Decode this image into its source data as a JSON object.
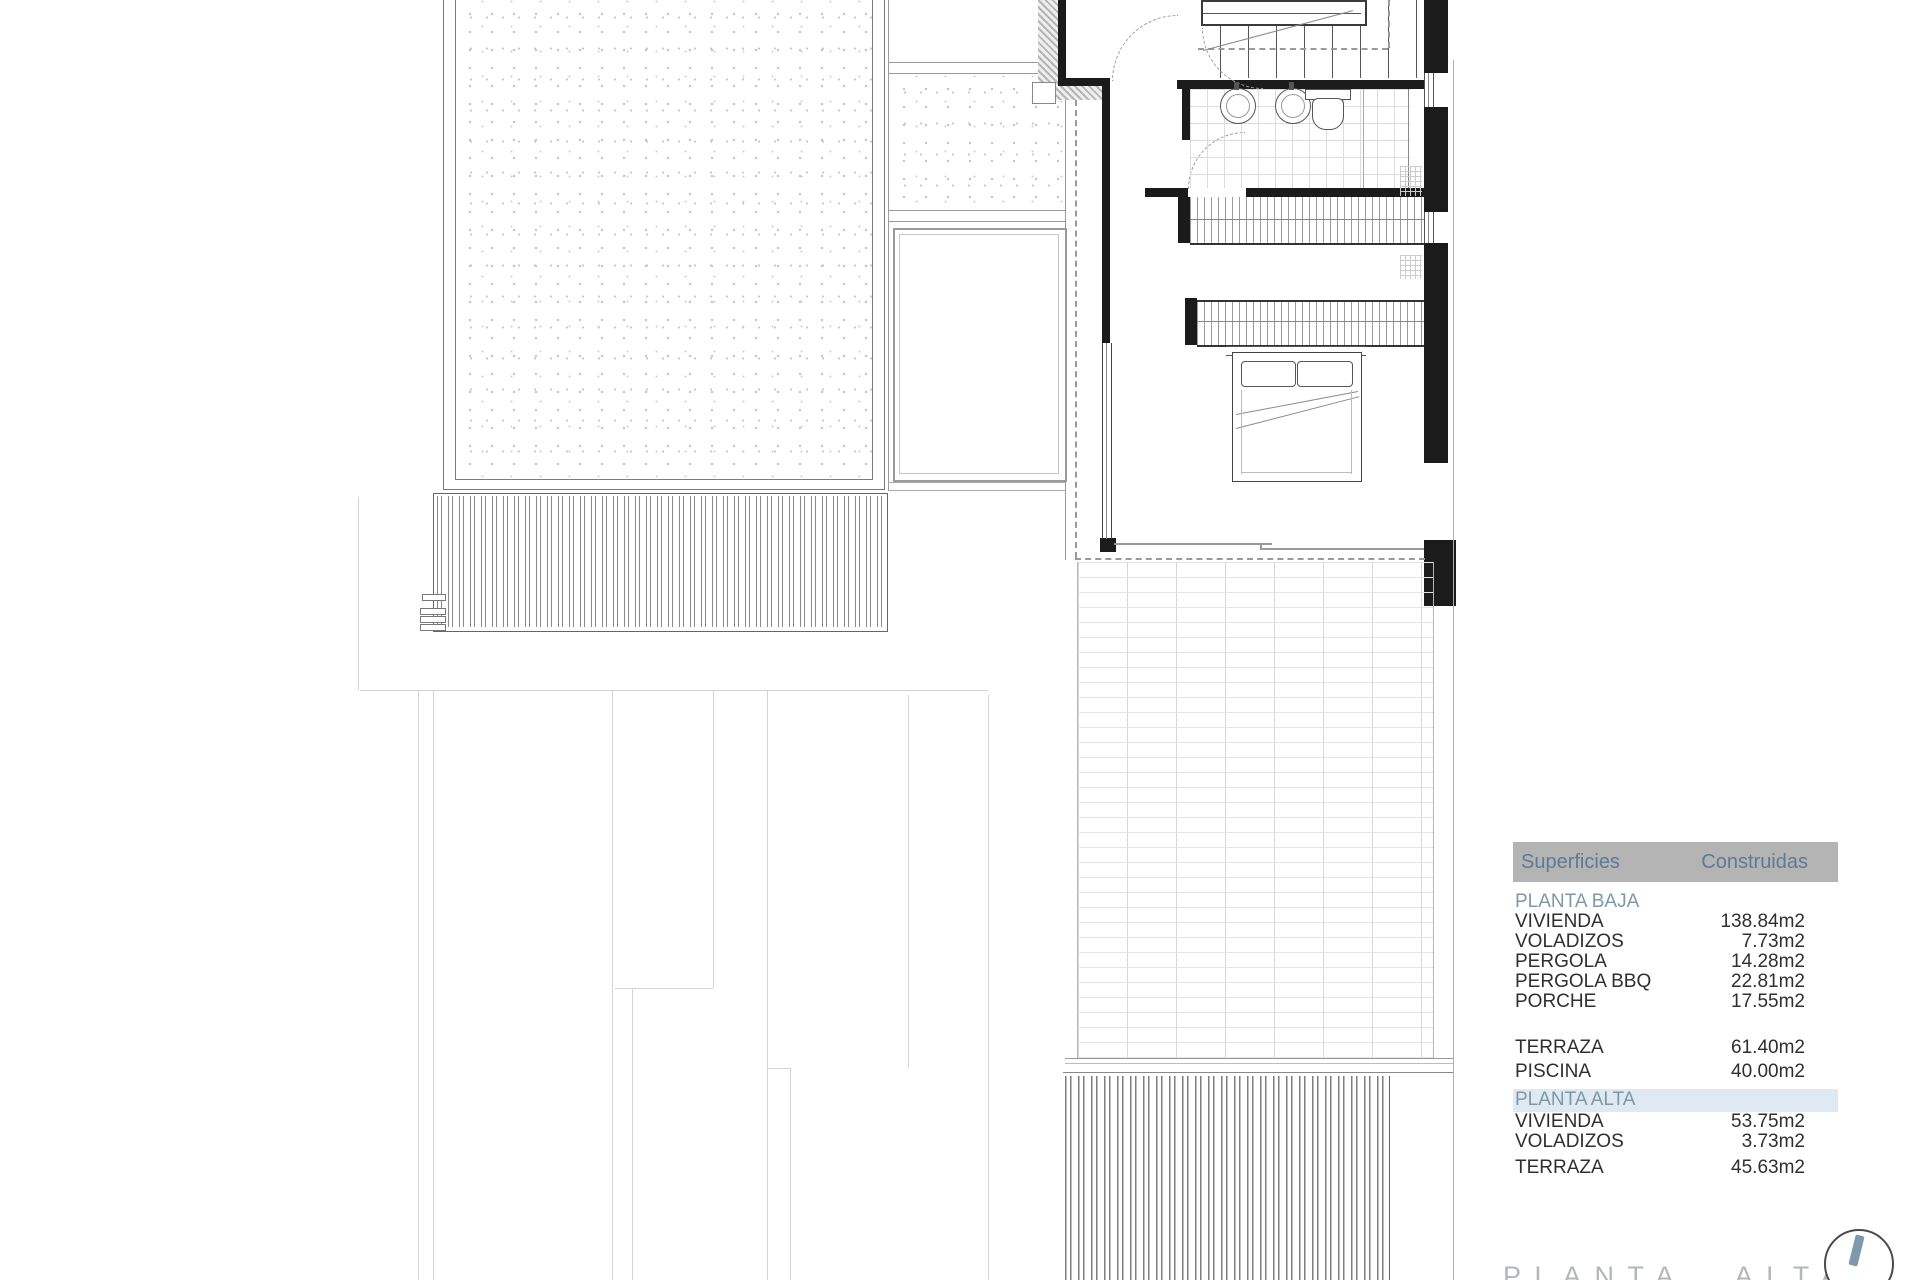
{
  "drawing": {
    "title": "PLANTA ALTA"
  },
  "areas_table": {
    "header": {
      "surfaces": "Superficies",
      "built": "Construidas"
    },
    "rows": [
      {
        "type": "section",
        "label": "PLANTA BAJA",
        "value": ""
      },
      {
        "type": "item",
        "label": "VIVIENDA",
        "value": "138.84m2"
      },
      {
        "type": "item",
        "label": "VOLADIZOS",
        "value": "7.73m2"
      },
      {
        "type": "item",
        "label": "PERGOLA",
        "value": "14.28m2"
      },
      {
        "type": "item",
        "label": "PERGOLA BBQ",
        "value": "22.81m2"
      },
      {
        "type": "item",
        "label": "PORCHE",
        "value": "17.55m2"
      },
      {
        "type": "item",
        "label": "TERRAZA",
        "value": "61.40m2"
      },
      {
        "type": "item",
        "label": "PISCINA",
        "value": "40.00m2"
      },
      {
        "type": "section",
        "label": "PLANTA ALTA",
        "value": ""
      },
      {
        "type": "item",
        "label": "VIVIENDA",
        "value": "53.75m2"
      },
      {
        "type": "item",
        "label": "VOLADIZOS",
        "value": "3.73m2"
      },
      {
        "type": "item",
        "label": "TERRAZA",
        "value": "45.63m2"
      }
    ]
  },
  "colors": {
    "table_header_bg": "#b4b4b4",
    "table_header_text": "#5d7b94",
    "section_heading": "#7e98a6",
    "title_gray": "#b3b7b9",
    "compass_needle": "#7e98ac"
  }
}
